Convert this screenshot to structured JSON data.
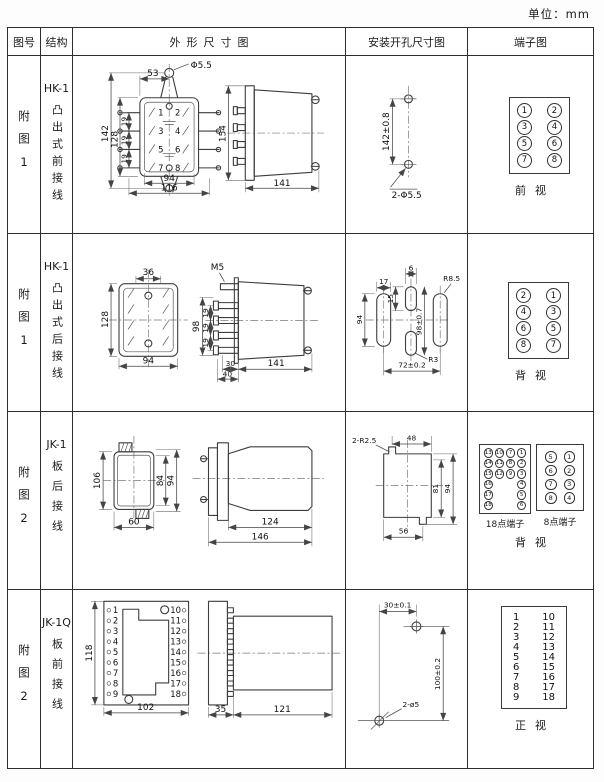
{
  "page": {
    "unit": "单位：mm"
  },
  "headers": {
    "fig": "图号",
    "structure": "结构",
    "outline": "外形尺寸图",
    "mounting": "安装开孔尺寸图",
    "terminal": "端子图"
  },
  "rows": [
    {
      "fig": "附图1",
      "model": "HK-1",
      "structure": "凸出式前接线",
      "outline": {
        "front": {
          "top_width": "53",
          "hole": "Φ5.5",
          "h_outer": "142",
          "h_inner": "128",
          "pitch": [
            "19",
            "19",
            "19"
          ],
          "w_inner": "94",
          "w_outer": "116",
          "pins": [
            "1",
            "2",
            "3",
            "4",
            "5",
            "6",
            "7",
            "8"
          ]
        },
        "side": {
          "height": "154",
          "depth": "141"
        }
      },
      "mounting": {
        "spacing": "142±0.8",
        "holes": "2-Φ5.5"
      },
      "terminal": {
        "left": [
          "1",
          "3",
          "5",
          "7"
        ],
        "right": [
          "2",
          "4",
          "6",
          "8"
        ],
        "view": "前视"
      }
    },
    {
      "fig": "附图1",
      "model": "HK-1",
      "structure": "凸出式后接线",
      "outline": {
        "front": {
          "top_width": "36",
          "height": "128",
          "width": "94"
        },
        "side": {
          "thread": "M5",
          "height": "98",
          "pitch": [
            "19",
            "19",
            "19"
          ],
          "d1": "30",
          "d2": "40",
          "depth": "141"
        }
      },
      "mounting": {
        "slot_width": "17",
        "center_width": "6",
        "center_height": "15",
        "slot_height": "94",
        "v_spacing": "98±0.7",
        "radius_large": "R8.5",
        "radius_small": "R3",
        "h_spacing": "72±0.2"
      },
      "terminal": {
        "left": [
          "2",
          "4",
          "6",
          "8"
        ],
        "right": [
          "1",
          "3",
          "5",
          "7"
        ],
        "view": "背视"
      }
    },
    {
      "fig": "附图2",
      "model": "JK-1",
      "structure": "板后接线",
      "outline": {
        "front": {
          "height": "106",
          "h_inner": "84",
          "h_outer": "94",
          "width": "60"
        },
        "side": {
          "depth_inner": "124",
          "depth_outer": "146"
        }
      },
      "mounting": {
        "corner_radius": "2-R2.5",
        "top_width": "48",
        "h_inner": "81",
        "h_outer": "94",
        "bottom_width": "56"
      },
      "terminal18": {
        "label": "18点端子",
        "cols": [
          [
            "13",
            "14",
            "15",
            "16",
            "17",
            "18"
          ],
          [
            "10",
            "11",
            "12"
          ],
          [
            "7",
            "8",
            "9"
          ],
          [
            "1",
            "2",
            "3",
            "4",
            "5",
            "6"
          ]
        ]
      },
      "terminal8": {
        "label": "8点端子",
        "left": [
          "5",
          "6",
          "7",
          "8"
        ],
        "right": [
          "1",
          "2",
          "3",
          "4"
        ]
      },
      "view": "背视"
    },
    {
      "fig": "附图2",
      "model": "JK-1Q",
      "structure": "板前接线",
      "outline": {
        "front": {
          "height": "118",
          "width": "102",
          "left_pins": [
            "1",
            "2",
            "3",
            "4",
            "5",
            "6",
            "7",
            "8",
            "9"
          ],
          "right_pins": [
            "10",
            "11",
            "12",
            "13",
            "14",
            "15",
            "16",
            "17",
            "18"
          ]
        },
        "side": {
          "flange": "35",
          "depth": "121"
        }
      },
      "mounting": {
        "h_spacing": "30±0.1",
        "v_spacing": "100±0.2",
        "holes": "2-ø5"
      },
      "terminal": {
        "left": [
          "1",
          "2",
          "3",
          "4",
          "5",
          "6",
          "7",
          "8",
          "9"
        ],
        "right": [
          "10",
          "11",
          "12",
          "13",
          "14",
          "15",
          "16",
          "17",
          "18"
        ],
        "view": "正视"
      }
    }
  ]
}
